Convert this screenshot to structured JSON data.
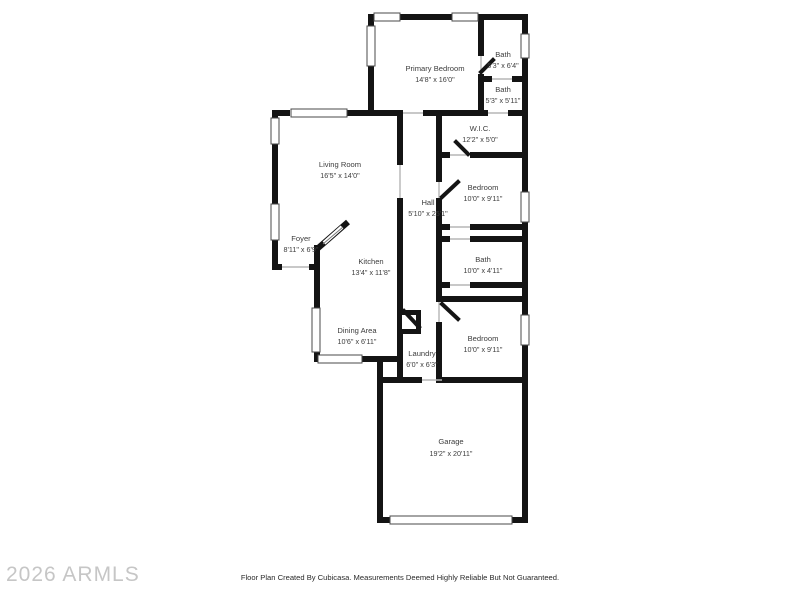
{
  "floor_plan": {
    "rooms": [
      {
        "name": "Primary Bedroom",
        "dims": "14'8\" x 16'0\""
      },
      {
        "name": "Bath",
        "dims": "5'3\" x 6'4\""
      },
      {
        "name": "Bath",
        "dims": "5'3\" x 5'11\""
      },
      {
        "name": "W.I.C.",
        "dims": "12'2\" x 5'0\""
      },
      {
        "name": "Living Room",
        "dims": "16'5\" x 14'0\""
      },
      {
        "name": "Bedroom",
        "dims": "10'0\" x 9'11\""
      },
      {
        "name": "Hall",
        "dims": "5'10\" x 25'1\""
      },
      {
        "name": "Foyer",
        "dims": "8'11\" x 6'9\""
      },
      {
        "name": "Kitchen",
        "dims": "13'4\" x 11'8\""
      },
      {
        "name": "Bath",
        "dims": "10'0\" x 4'11\""
      },
      {
        "name": "Dining Area",
        "dims": "10'6\" x 6'11\""
      },
      {
        "name": "Laundry",
        "dims": "6'0\" x 6'3\""
      },
      {
        "name": "Bedroom",
        "dims": "10'0\" x 9'11\""
      },
      {
        "name": "Garage",
        "dims": "19'2\" x 20'11\""
      }
    ],
    "watermark": "2026 ARMLS",
    "disclaimer": "Floor Plan Created By Cubicasa. Measurements Deemed Highly Reliable But Not Guaranteed.",
    "colors": {
      "wall": "#141414",
      "label": "#3d3d3d",
      "watermark": "#c6c6c6",
      "background": "#ffffff"
    }
  }
}
